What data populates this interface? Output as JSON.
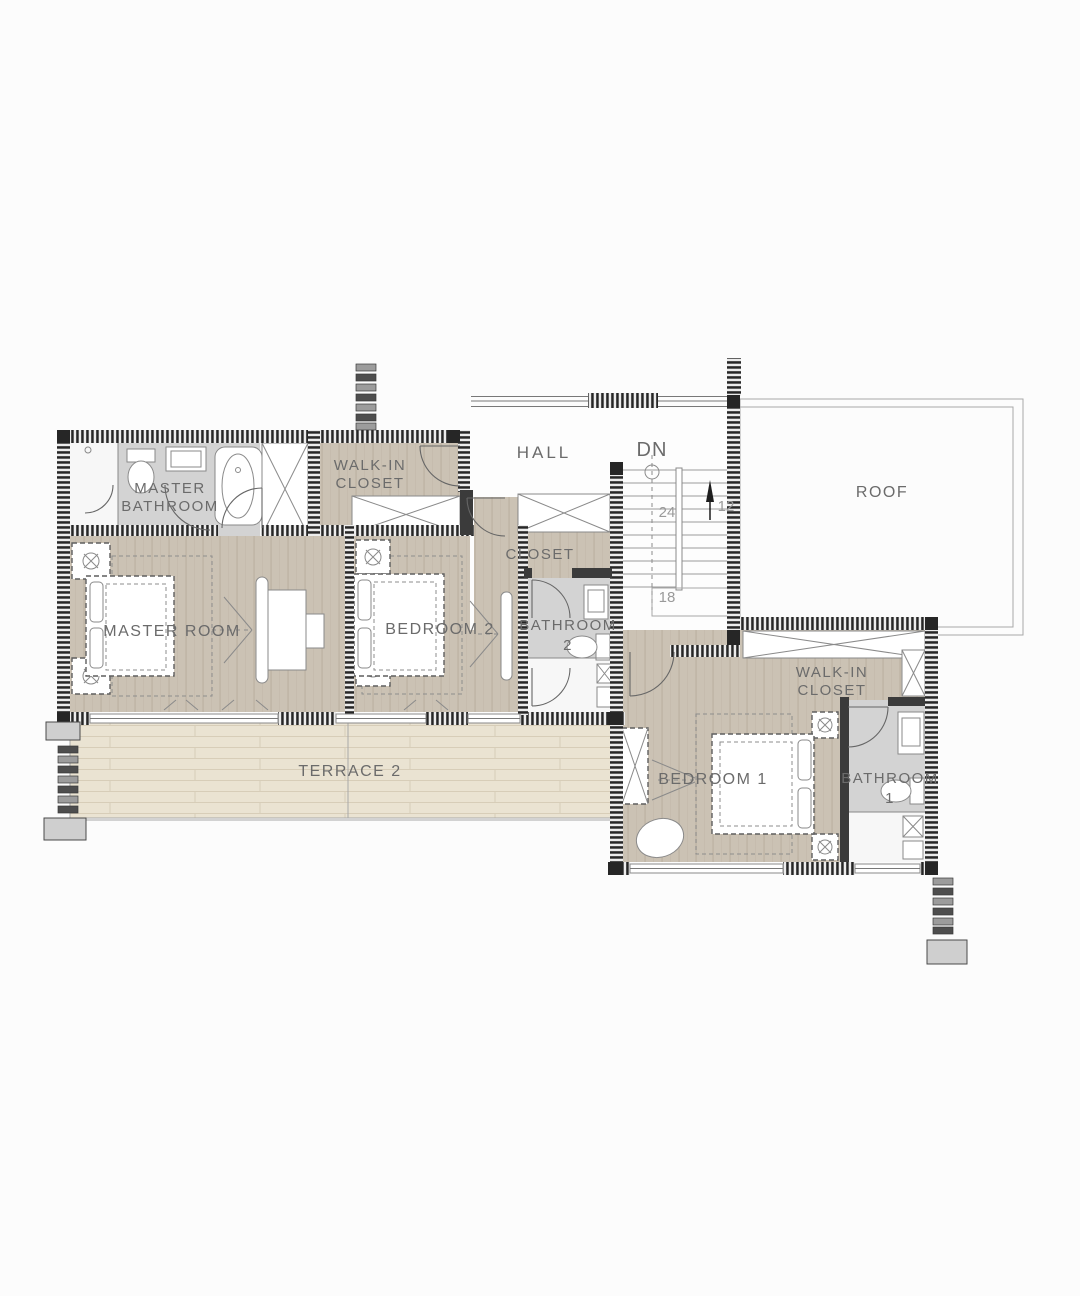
{
  "plan": {
    "rooms": {
      "master_bathroom": {
        "line1": "MASTER",
        "line2": "BATHROOM"
      },
      "walk_in_closet_left": {
        "line1": "WALK-IN",
        "line2": "CLOSET"
      },
      "hall": {
        "label": "HALL"
      },
      "roof": {
        "label": "ROOF"
      },
      "master_room": {
        "label": "MASTER ROOM"
      },
      "bedroom_2": {
        "label": "BEDROOM 2"
      },
      "closet": {
        "label": "CLOSET"
      },
      "bathroom_2": {
        "line1": "BATHROOM",
        "line2": "2"
      },
      "walk_in_closet_right": {
        "line1": "WALK-IN",
        "line2": "CLOSET"
      },
      "bedroom_1": {
        "label": "BEDROOM 1"
      },
      "bathroom_1": {
        "line1": "BATHROOM",
        "line2": "1"
      },
      "terrace_2": {
        "label": "TERRACE 2"
      }
    },
    "stairs": {
      "direction_label": "DN",
      "tread_count_left": "24",
      "tread_count_right": "12",
      "tread_count_landing": "18"
    },
    "colors": {
      "wood_floor": "#cbc2b4",
      "terrace_floor": "#eae3d2",
      "bathroom_floor": "#d3d3d3",
      "wall": "#262626",
      "label_text": "#6b6b6b",
      "background": "#fcfcfc"
    }
  }
}
